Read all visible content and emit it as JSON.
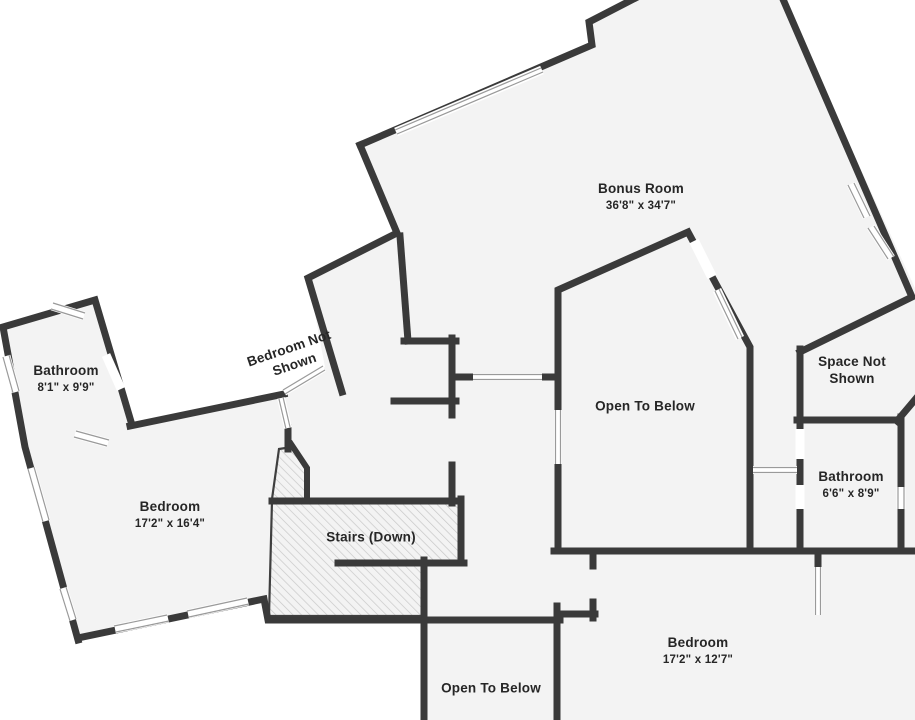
{
  "palette": {
    "wall": "#3a3a3a",
    "floor": "#f3f3f3",
    "outside": "#ffffff",
    "hatch_line": "#c7c7c7",
    "window_line": "#9a9a9a",
    "text": "#262626"
  },
  "rooms": [
    {
      "name": "Bonus Room",
      "dims": "36'8\" x 34'7\""
    },
    {
      "name": "Bathroom",
      "dims": "8'1\" x 9'9\""
    },
    {
      "name": "Bedroom Not Shown"
    },
    {
      "name": "Space Not Shown"
    },
    {
      "name": "Open To Below"
    },
    {
      "name": "Bathroom",
      "dims": "6'6\" x 8'9\""
    },
    {
      "name": "Bedroom",
      "dims": "17'2\" x 16'4\""
    },
    {
      "name": "Stairs (Down)"
    },
    {
      "name": "Bedroom",
      "dims": "17'2\" x 12'7\""
    },
    {
      "name": "Open To Below"
    }
  ]
}
